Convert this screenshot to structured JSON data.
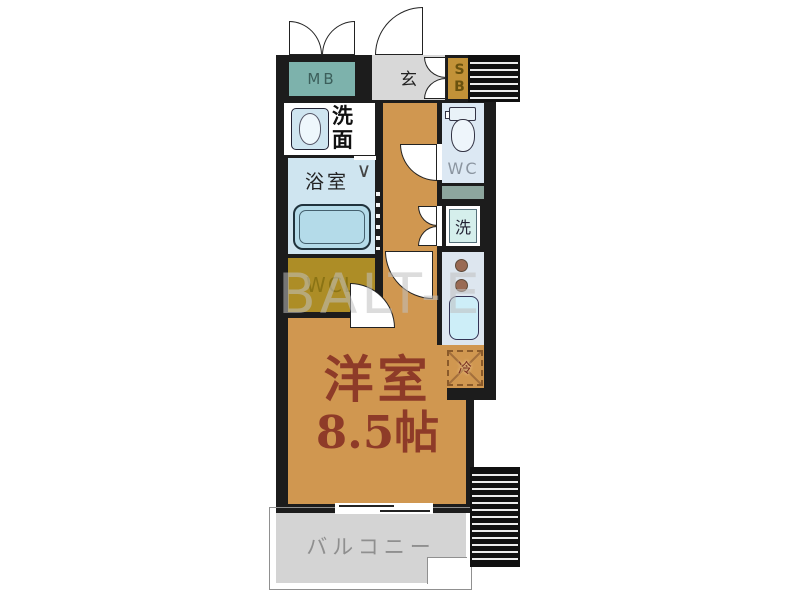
{
  "plan": {
    "labels": {
      "mb": "MB",
      "entrance": "玄",
      "sb": [
        "S",
        "B"
      ],
      "washroom": "洗面",
      "bathroom": "浴室",
      "wc": "WC",
      "washer": "洗",
      "closet": "WCL",
      "fridge": "冷",
      "room_name": "洋室",
      "room_size": "8.5帖",
      "balcony": "バルコニー"
    },
    "watermark": "BALT-E"
  },
  "colors": {
    "wall": "#1c1c1c",
    "floor-tan": "#d09750",
    "mb-teal": "#7db2ac",
    "sb-gold": "#c29238",
    "wcl-olive": "#ad8d26",
    "genkan-gray": "#d8d8d8",
    "bath-blue": "#cfe5f0",
    "tub-blue": "#b4dbe9",
    "wc-blue": "#dce8f3",
    "counter-blue": "#dde6ef",
    "sink-blue": "#cdeef8",
    "washer-teal": "#d5efec",
    "shelf-teal": "#8da69e",
    "balcony-gray": "#d4d4d4",
    "room-text": "#8e3b28",
    "burner-brown": "#996a53",
    "balcony-text": "#8f8f8f",
    "watermark-gray": "#c0c0c0"
  }
}
